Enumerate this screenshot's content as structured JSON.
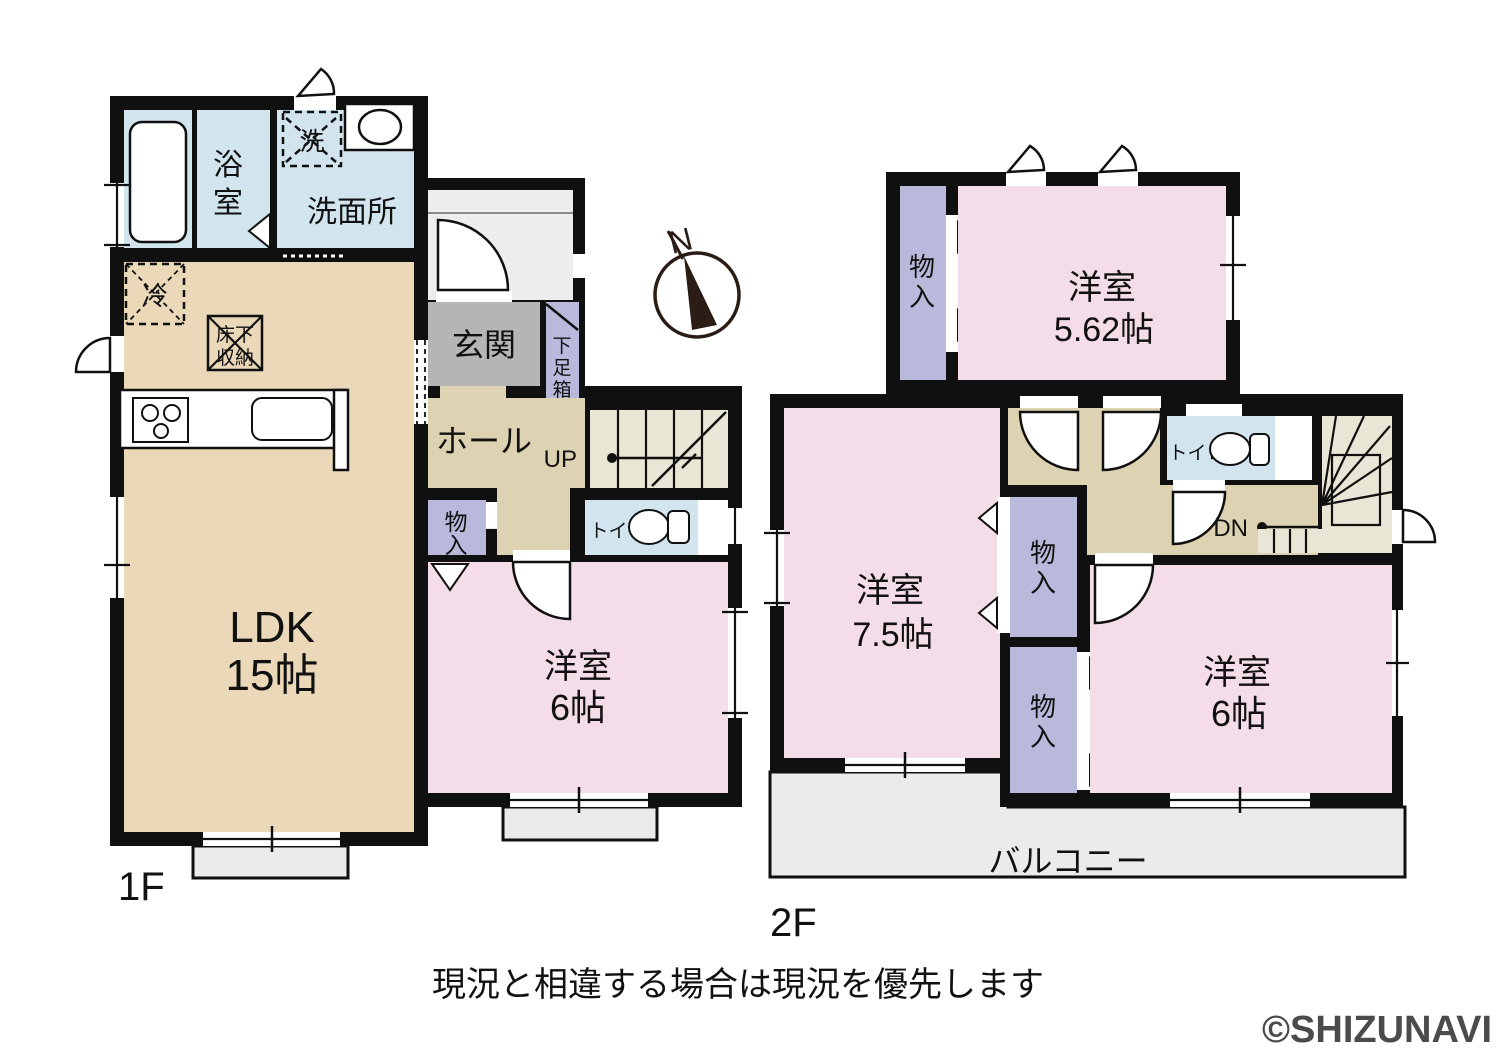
{
  "compass": {
    "north": "N"
  },
  "floor1": {
    "label": "1F",
    "bath": [
      "浴",
      "室"
    ],
    "washer": "洗",
    "washroom": "洗面所",
    "fridge": "冷",
    "floor_storage": [
      "床下",
      "収納"
    ],
    "entrance": "玄関",
    "shoe_box": [
      "下",
      "足",
      "箱"
    ],
    "hall": "ホール",
    "up": "UP",
    "toilet": "トイレ",
    "ldk": [
      "LDK",
      "15帖"
    ],
    "western_room_6": [
      "洋室",
      "6帖"
    ]
  },
  "floor2": {
    "label": "2F",
    "western_room_562": [
      "洋室",
      "5.62帖"
    ],
    "western_room_75": [
      "洋室",
      "7.5帖"
    ],
    "western_room_6": [
      "洋室",
      "6帖"
    ],
    "toilet": "トイレ",
    "dn": "DN",
    "balcony": "バルコニー"
  },
  "storage": [
    "物",
    "入"
  ],
  "footer": {
    "disclaimer": "現況と相違する場合は現況を優先します",
    "copyright": "©SHIZUNAVI"
  },
  "colors": {
    "wall": "#101010",
    "room_pink": "#f4dce8",
    "ldk_tan": "#ead8b9",
    "hall_tan": "#ddd2b2",
    "water_blue": "#d2e5ef",
    "storage_purple": "#b9badb",
    "entrance_gray": "#b5b5b6",
    "stairs_cream": "#eae6d5",
    "outdoor_gray": "#ebebeb"
  }
}
